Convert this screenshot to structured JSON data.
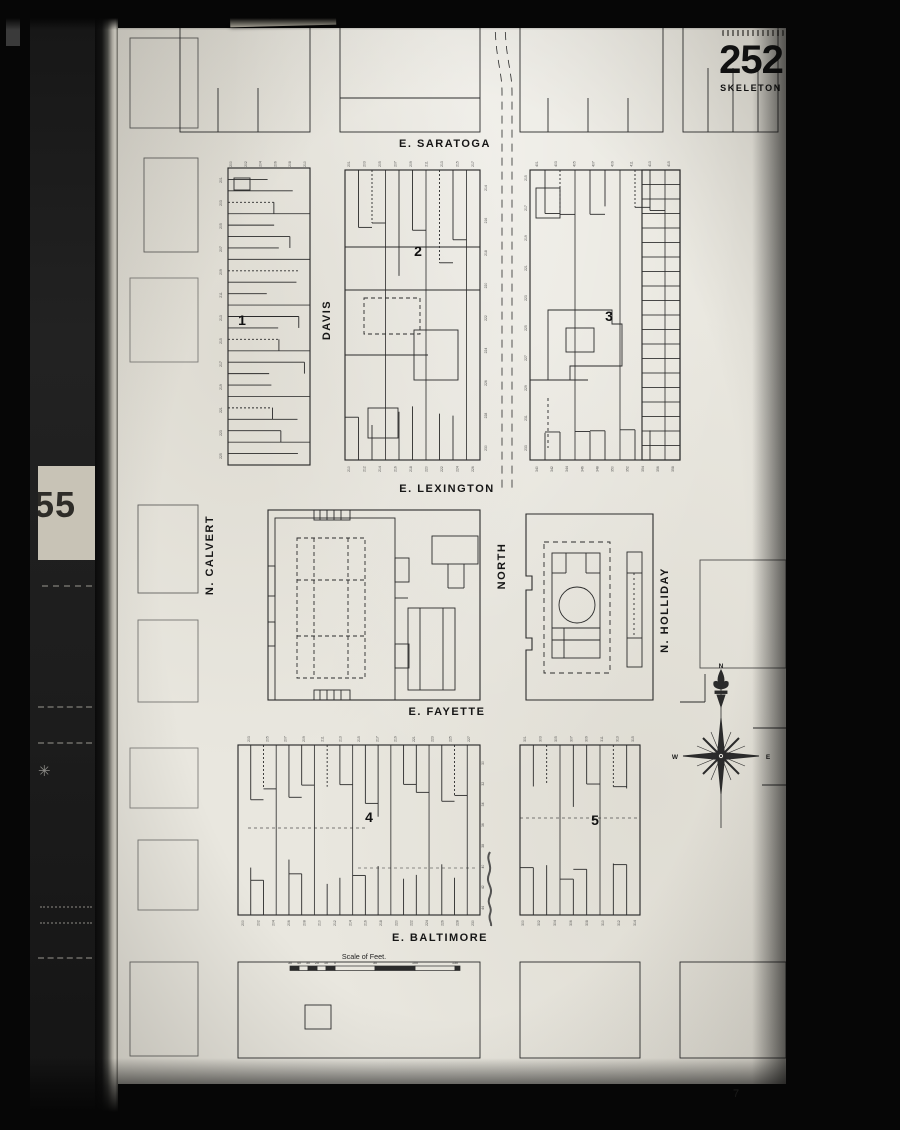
{
  "film": {
    "tag_label": "Double p. per exp.",
    "adjacent_sheet": "55",
    "bottom_mark": "7"
  },
  "sheet": {
    "number": "252",
    "type_label": "SKELETON"
  },
  "map": {
    "ink": "#2b2b2b",
    "streets_h": [
      {
        "label": "E. SARATOGA",
        "x": 327,
        "y": 119
      },
      {
        "label": "E. LEXINGTON",
        "x": 329,
        "y": 464
      },
      {
        "label": "E. FAYETTE",
        "x": 329,
        "y": 687
      },
      {
        "label": "E. BALTIMORE",
        "x": 322,
        "y": 913
      }
    ],
    "streets_v": [
      {
        "label": "N. CALVERT",
        "x": 95,
        "y": 527
      },
      {
        "label": "DAVIS",
        "x": 212,
        "y": 292
      },
      {
        "label": "NORTH",
        "x": 387,
        "y": 538
      },
      {
        "label": "N. HOLLIDAY",
        "x": 550,
        "y": 582
      }
    ],
    "block_numbers": [
      {
        "label": "1",
        "x": 124,
        "y": 297
      },
      {
        "label": "2",
        "x": 300,
        "y": 228
      },
      {
        "label": "3",
        "x": 491,
        "y": 293
      },
      {
        "label": "4",
        "x": 251,
        "y": 794
      },
      {
        "label": "5",
        "x": 477,
        "y": 797
      }
    ],
    "compass": {
      "labels": [
        {
          "t": "N",
          "x": 603,
          "y": 640
        },
        {
          "t": "W",
          "x": 557,
          "y": 731
        },
        {
          "t": "E",
          "x": 650,
          "y": 731
        }
      ]
    },
    "scale": {
      "label": "Scale of Feet.",
      "label_x": 246,
      "label_y": 931,
      "bar": {
        "x": 172,
        "y": 938,
        "w": 170,
        "h": 4.5
      },
      "cells": [
        [
          172,
          181,
          1
        ],
        [
          181,
          190,
          0
        ],
        [
          190,
          199,
          1
        ],
        [
          199,
          208,
          0
        ],
        [
          208,
          217,
          1
        ],
        [
          217,
          257,
          0
        ],
        [
          257,
          297,
          1
        ],
        [
          297,
          337,
          0
        ],
        [
          337,
          342,
          1
        ]
      ],
      "ticks": [
        {
          "t": "50",
          "x": 172
        },
        {
          "t": "40",
          "x": 181
        },
        {
          "t": "30",
          "x": 190
        },
        {
          "t": "20",
          "x": 199
        },
        {
          "t": "10",
          "x": 208
        },
        {
          "t": "0",
          "x": 217
        },
        {
          "t": "50",
          "x": 257
        },
        {
          "t": "100",
          "x": 297
        },
        {
          "t": "150",
          "x": 337
        }
      ]
    },
    "lot_blocks": [
      {
        "seed": 7,
        "rect": [
          110,
          140,
          82,
          297
        ],
        "dir": "h",
        "n": 26,
        "min": 38,
        "max": 80
      },
      {
        "seed": 11,
        "rect": [
          227,
          142,
          135,
          290
        ],
        "dir": "v",
        "n": 10,
        "tmin": 50,
        "tmax": 115,
        "bmin": 35,
        "bmax": 62
      },
      {
        "seed": 23,
        "rect": [
          412,
          142,
          150,
          290
        ],
        "dir": "v",
        "n": 10,
        "tmin": 36,
        "tmax": 58,
        "bmin": 26,
        "bmax": 40
      },
      {
        "seed": 5,
        "rect": [
          524,
          142,
          38,
          290
        ],
        "dir": "ladder",
        "n": 20
      },
      {
        "seed": 31,
        "rect": [
          120,
          717,
          242,
          170
        ],
        "dir": "v",
        "n": 19,
        "tmin": 38,
        "tmax": 72,
        "bmin": 30,
        "bmax": 58
      },
      {
        "seed": 41,
        "rect": [
          402,
          717,
          120,
          170
        ],
        "dir": "v",
        "n": 9,
        "tmin": 36,
        "tmax": 66,
        "bmin": 30,
        "bmax": 52
      }
    ],
    "tiny_numbers": [
      {
        "x": 104,
        "y0": 152,
        "y1": 428,
        "start": 201,
        "step": 2,
        "count": 13
      },
      {
        "y": 136,
        "x0": 114,
        "x1": 188,
        "start": 200,
        "step": 2,
        "count": 6
      },
      {
        "y": 136,
        "x0": 232,
        "x1": 356,
        "start": 201,
        "step": 2,
        "count": 9
      },
      {
        "y": 441,
        "x0": 232,
        "x1": 356,
        "start": 210,
        "step": 2,
        "count": 9
      },
      {
        "y": 136,
        "x0": 420,
        "x1": 552,
        "start": 401,
        "step": 2,
        "count": 8
      },
      {
        "x": 409,
        "y0": 150,
        "y1": 420,
        "start": 215,
        "step": 2,
        "count": 10
      },
      {
        "x": 369,
        "y0": 160,
        "y1": 420,
        "start": 214,
        "step": 2,
        "count": 9
      },
      {
        "y": 441,
        "x0": 420,
        "x1": 556,
        "start": 340,
        "step": 2,
        "count": 10
      },
      {
        "y": 711,
        "x0": 132,
        "x1": 352,
        "start": 203,
        "step": 2,
        "count": 13
      },
      {
        "y": 895,
        "x0": 126,
        "x1": 356,
        "start": 200,
        "step": 2,
        "count": 16
      },
      {
        "y": 711,
        "x0": 408,
        "x1": 516,
        "start": 301,
        "step": 2,
        "count": 8
      },
      {
        "y": 895,
        "x0": 406,
        "x1": 518,
        "start": 300,
        "step": 2,
        "count": 8
      },
      {
        "x": 366,
        "y0": 735,
        "y1": 880,
        "start": 30,
        "step": 2,
        "count": 8
      }
    ],
    "shapes": [
      [
        "r",
        62,
        -12,
        130,
        116
      ],
      [
        "l",
        100,
        60,
        100,
        104
      ],
      [
        "l",
        140,
        60,
        140,
        104
      ],
      [
        "r",
        222,
        -12,
        140,
        116
      ],
      [
        "l",
        222,
        70,
        362,
        70
      ],
      [
        "r",
        402,
        -12,
        143,
        116
      ],
      [
        "l",
        430,
        70,
        430,
        104
      ],
      [
        "l",
        470,
        70,
        470,
        104
      ],
      [
        "l",
        510,
        70,
        510,
        104
      ],
      [
        "r",
        565,
        -12,
        95,
        116
      ],
      [
        "l",
        590,
        40,
        590,
        104
      ],
      [
        "l",
        615,
        40,
        615,
        104
      ],
      [
        "l",
        640,
        40,
        640,
        104
      ],
      [
        "p",
        "M377,-10 C377,30 384,42 384,64 L384,462",
        {
          "d": "8 6",
          "w": 0.8
        }
      ],
      [
        "p",
        "M387,-10 C387,30 394,42 394,64 L394,462",
        {
          "d": "8 6",
          "w": 0.8
        }
      ],
      [
        "l",
        227,
        219,
        362,
        219
      ],
      [
        "l",
        227,
        262,
        362,
        262
      ],
      [
        "l",
        227,
        327,
        310,
        327
      ],
      [
        "r",
        246,
        270,
        56,
        36,
        {
          "d": "4 3"
        }
      ],
      [
        "r",
        296,
        302,
        44,
        50
      ],
      [
        "r",
        250,
        380,
        30,
        30
      ],
      [
        "l",
        412,
        352,
        470,
        352
      ],
      [
        "p",
        "M430,282 h64 v14 h10 v42 h-52 v14 h-22 z"
      ],
      [
        "r",
        448,
        300,
        28,
        24
      ],
      [
        "l",
        430,
        370,
        430,
        420,
        {
          "d": "3 3"
        }
      ],
      [
        "r",
        418,
        160,
        24,
        30
      ],
      [
        "r",
        150,
        482,
        212,
        190,
        {
          "w": 1.1
        }
      ],
      [
        "r",
        157,
        490,
        120,
        182
      ],
      [
        "r",
        196,
        482,
        36,
        10
      ],
      [
        "l",
        202,
        482,
        202,
        492
      ],
      [
        "l",
        209,
        482,
        209,
        492
      ],
      [
        "l",
        216,
        482,
        216,
        492
      ],
      [
        "l",
        223,
        482,
        223,
        492
      ],
      [
        "r",
        196,
        662,
        36,
        10
      ],
      [
        "l",
        202,
        662,
        202,
        672
      ],
      [
        "l",
        209,
        662,
        209,
        672
      ],
      [
        "l",
        216,
        662,
        216,
        672
      ],
      [
        "l",
        223,
        662,
        223,
        672
      ],
      [
        "r",
        179,
        510,
        68,
        140,
        {
          "d": "4 3"
        }
      ],
      [
        "l",
        196,
        510,
        196,
        650,
        {
          "d": "4 3"
        }
      ],
      [
        "l",
        230,
        510,
        230,
        650,
        {
          "d": "4 3"
        }
      ],
      [
        "l",
        179,
        552,
        247,
        552,
        {
          "d": "4 3"
        }
      ],
      [
        "l",
        179,
        608,
        247,
        608,
        {
          "d": "4 3"
        }
      ],
      [
        "r",
        150,
        538,
        7,
        30
      ],
      [
        "r",
        150,
        594,
        7,
        24
      ],
      [
        "r",
        277,
        530,
        14,
        24
      ],
      [
        "r",
        277,
        616,
        14,
        24
      ],
      [
        "r",
        314,
        508,
        46,
        28
      ],
      [
        "l",
        330,
        536,
        330,
        560
      ],
      [
        "l",
        346,
        536,
        346,
        560
      ],
      [
        "l",
        330,
        560,
        346,
        560
      ],
      [
        "r",
        290,
        580,
        47,
        82
      ],
      [
        "l",
        302,
        580,
        302,
        662
      ],
      [
        "l",
        325,
        580,
        325,
        662
      ],
      [
        "l",
        277,
        570,
        290,
        570
      ],
      [
        "p",
        "M408,486 H535 V672 H408 V622 l6,0 0,-12 -6,0 V562 l6,0 0,-14 -6,0 Z",
        {
          "w": 1.1
        }
      ],
      [
        "r",
        426,
        514,
        66,
        131,
        {
          "d": "5 4"
        }
      ],
      [
        "r",
        434,
        525,
        48,
        105
      ],
      [
        "l",
        434,
        545,
        448,
        545
      ],
      [
        "l",
        448,
        525,
        448,
        545
      ],
      [
        "l",
        482,
        545,
        468,
        545
      ],
      [
        "l",
        468,
        525,
        468,
        545
      ],
      [
        "c",
        459,
        577,
        18
      ],
      [
        "l",
        434,
        600,
        482,
        600
      ],
      [
        "l",
        434,
        612,
        482,
        612
      ],
      [
        "l",
        446,
        600,
        446,
        630
      ],
      [
        "r",
        509,
        524,
        15,
        115
      ],
      [
        "l",
        509,
        545,
        524,
        545
      ],
      [
        "l",
        509,
        610,
        524,
        610
      ],
      [
        "l",
        516,
        545,
        516,
        610,
        {
          "d": "2 3"
        }
      ],
      [
        "p",
        "M372,824 c-5,8 3,12 -1,22 c-4,10 5,12 1,22 c-4,9 3,10 0,18 c-2,6 2,8 1,12",
        {
          "w": 2,
          "s": "#3a3a3a",
          "o": 0.85
        }
      ],
      [
        "l",
        130,
        800,
        250,
        800,
        {
          "d": "3 3",
          "o": 0.6
        }
      ],
      [
        "l",
        402,
        790,
        522,
        790,
        {
          "d": "3 3",
          "o": 0.6
        }
      ],
      [
        "l",
        240,
        840,
        360,
        840,
        {
          "d": "3 3",
          "o": 0.5
        }
      ],
      [
        "r",
        116,
        150,
        16,
        12
      ],
      [
        "l",
        587,
        646,
        587,
        674
      ],
      [
        "l",
        562,
        674,
        587,
        674
      ],
      [
        "l",
        635,
        700,
        668,
        700
      ],
      [
        "l",
        644,
        757,
        668,
        757
      ],
      [
        "r",
        582,
        532,
        86,
        108,
        {
          "o": 0.8
        }
      ],
      [
        "r",
        562,
        934,
        106,
        96
      ],
      [
        "r",
        12,
        10,
        68,
        90,
        {
          "o": 0.75
        }
      ],
      [
        "r",
        26,
        130,
        54,
        94,
        {
          "o": 0.7
        }
      ],
      [
        "r",
        12,
        250,
        68,
        84,
        {
          "o": 0.55
        }
      ],
      [
        "r",
        20,
        477,
        60,
        88,
        {
          "o": 0.7
        }
      ],
      [
        "r",
        20,
        592,
        60,
        82,
        {
          "o": 0.6
        }
      ],
      [
        "r",
        12,
        720,
        68,
        60,
        {
          "o": 0.55
        }
      ],
      [
        "r",
        20,
        812,
        60,
        70,
        {
          "o": 0.6
        }
      ],
      [
        "r",
        12,
        934,
        68,
        94,
        {
          "o": 0.7
        }
      ],
      [
        "r",
        120,
        934,
        242,
        96
      ],
      [
        "r",
        402,
        934,
        120,
        96
      ],
      [
        "r",
        187,
        977,
        26,
        24
      ],
      [
        "l",
        603,
        658,
        603,
        800,
        {
          "w": 0.8
        }
      ],
      [
        "p",
        "M603,642 c-4,8 -4,12 0,18 c4,-6 4,-10 0,-18 Z",
        {
          "f": 1
        }
      ],
      [
        "p",
        "M596,654 c3,-2 5,0 7,7 c-6,-1 -8,-3 -7,-7 Z",
        {
          "f": 1
        }
      ],
      [
        "p",
        "M610,654 c-3,-2 -5,0 -7,7 c6,-1 8,-3 7,-7 Z",
        {
          "f": 1
        }
      ],
      [
        "r",
        597,
        663,
        12,
        2.5,
        {
          "f": 1
        }
      ],
      [
        "p",
        "M599,667 l4,12 4,-12 Z",
        {
          "f": 1
        }
      ],
      [
        "p",
        "M603,690 L606.5,726 L603,730 L599.5,726 Z",
        {
          "f": 1
        }
      ],
      [
        "p",
        "M603,766 L606.5,730 L603,726 L599.5,730 Z",
        {
          "f": 1
        }
      ],
      [
        "p",
        "M641,728 L605,731.5 L601,728 L605,724.5 Z",
        {
          "f": 1
        }
      ],
      [
        "p",
        "M565,728 L601,731.5 L605,728 L601,724.5 Z",
        {
          "f": 1
        }
      ],
      [
        "l",
        603,
        728,
        621,
        710,
        {
          "w": 2
        }
      ],
      [
        "l",
        603,
        728,
        621,
        746,
        {
          "w": 2
        }
      ],
      [
        "l",
        603,
        728,
        585,
        746,
        {
          "w": 2
        }
      ],
      [
        "l",
        603,
        728,
        585,
        710,
        {
          "w": 2
        }
      ],
      [
        "l",
        603,
        728,
        613,
        704,
        {
          "w": 0.6
        }
      ],
      [
        "l",
        603,
        728,
        627,
        718,
        {
          "w": 0.6
        }
      ],
      [
        "l",
        603,
        728,
        627,
        738,
        {
          "w": 0.6
        }
      ],
      [
        "l",
        603,
        728,
        613,
        752,
        {
          "w": 0.6
        }
      ],
      [
        "l",
        603,
        728,
        593,
        752,
        {
          "w": 0.6
        }
      ],
      [
        "l",
        603,
        728,
        579,
        738,
        {
          "w": 0.6
        }
      ],
      [
        "l",
        603,
        728,
        579,
        718,
        {
          "w": 0.6
        }
      ],
      [
        "l",
        603,
        728,
        593,
        704,
        {
          "w": 0.6
        }
      ],
      [
        "c",
        603,
        728,
        4,
        {
          "f": 1
        }
      ],
      [
        "c",
        603,
        728,
        1.6,
        {
          "s": "#e8e6df",
          "w": 1
        }
      ]
    ]
  }
}
